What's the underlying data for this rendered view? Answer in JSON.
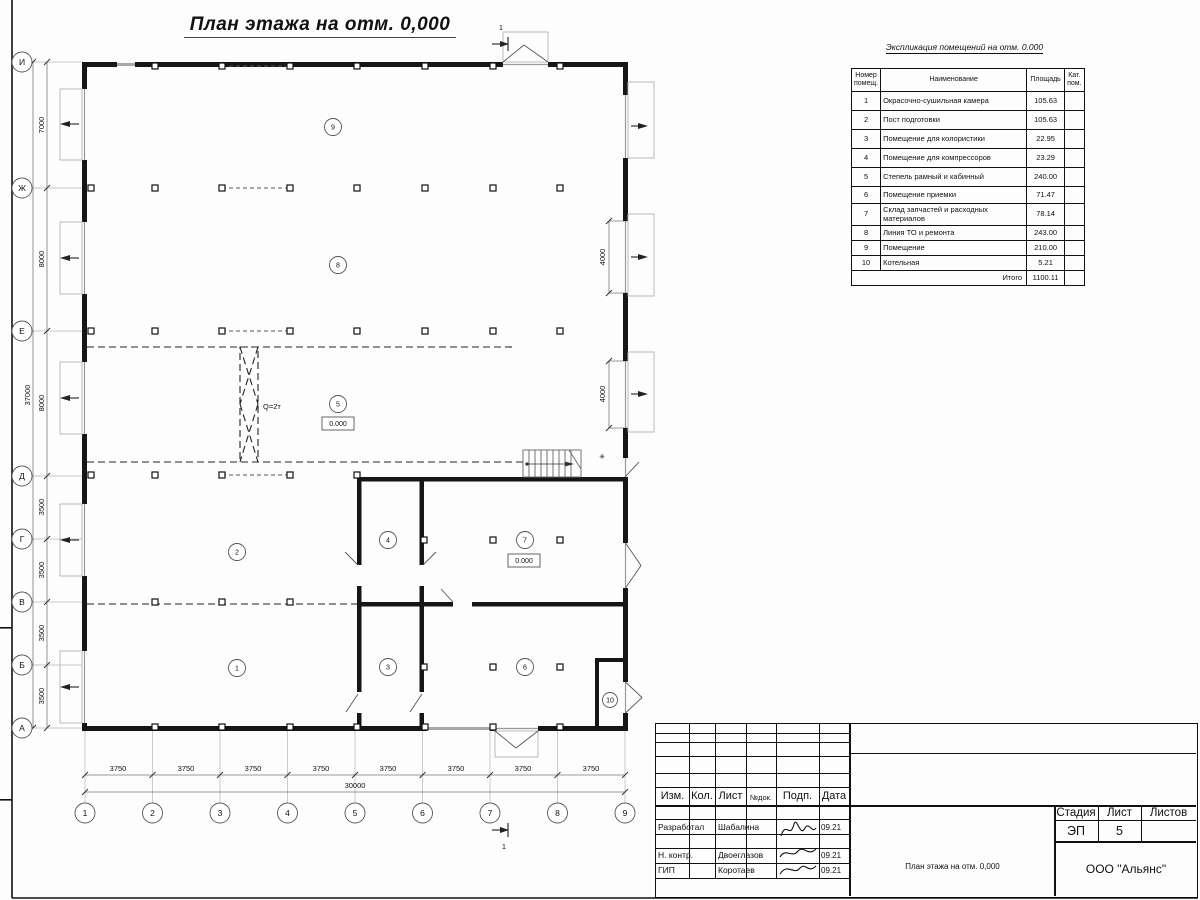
{
  "sheet": {
    "plan_title": "План этажа на отм. 0,000"
  },
  "plan": {
    "axes_left": [
      "И",
      "Ж",
      "Е",
      "Д",
      "Г",
      "В",
      "Б",
      "А"
    ],
    "axes_bottom": [
      "1",
      "2",
      "3",
      "4",
      "5",
      "6",
      "7",
      "8",
      "9"
    ],
    "dims_left": [
      "7000",
      "8000",
      "8000",
      "3500",
      "3500",
      "3500",
      "3500"
    ],
    "dim_left_total": "37000",
    "dims_bottom": [
      "3750",
      "3750",
      "3750",
      "3750",
      "3750",
      "3750",
      "3750",
      "3750"
    ],
    "dim_bottom_total": "30000",
    "dims_right": [
      "4000",
      "4000"
    ],
    "crane_label": "Q=2т",
    "level_marks": [
      "0.000",
      "0.000"
    ],
    "stair_mark": "✳",
    "section_marks": [
      "1",
      "1"
    ],
    "room_numbers": [
      "1",
      "2",
      "3",
      "4",
      "5",
      "6",
      "7",
      "8",
      "9",
      "10"
    ]
  },
  "explication": {
    "title": "Экспликация помещений на отм. 0.000",
    "headers": {
      "num1": "Номер",
      "num2": "помещ.",
      "name": "Наименование",
      "area": "Площадь",
      "cat1": "Кат.",
      "cat2": "пом."
    },
    "rows": [
      {
        "num": "1",
        "name": "Окрасочно-сушильная камера",
        "area": "105.63"
      },
      {
        "num": "2",
        "name": "Пост подготовки",
        "area": "105.63"
      },
      {
        "num": "3",
        "name": "Помещение для колористики",
        "area": "22.95"
      },
      {
        "num": "4",
        "name": "Помещение для компрессоров",
        "area": "23.29"
      },
      {
        "num": "5",
        "name": "Степель рамный и кабинный",
        "area": "240.00"
      },
      {
        "num": "6",
        "name": "Помещение приемки",
        "area": "71.47"
      },
      {
        "num": "7",
        "name": "Склад запчастей и расходных материалов",
        "area": "78.14"
      },
      {
        "num": "8",
        "name": "Линия ТО и ремонта",
        "area": "243.00"
      },
      {
        "num": "9",
        "name": "Помещение",
        "area": "210.00"
      },
      {
        "num": "10",
        "name": "Котельная",
        "area": "5.21"
      }
    ],
    "total_label": "Итого",
    "total_value": "1100.11"
  },
  "title_block": {
    "header_cols": [
      "Изм.",
      "Кол.",
      "Лист",
      "№док.",
      "Подп.",
      "Дата"
    ],
    "rows": [
      {
        "role": "Разработал",
        "name": "Шабалина",
        "date": "09.21"
      },
      {
        "role": "Н. контр.",
        "name": "Двоеглазов",
        "date": "09.21"
      },
      {
        "role": "ГИП",
        "name": "Коротаев",
        "date": "09.21"
      }
    ],
    "doc_title": "План этажа на отм. 0,000",
    "stage_label": "Стадия",
    "sheet_label": "Лист",
    "sheets_label": "Листов",
    "stage_value": "ЭП",
    "sheet_value": "5",
    "company": "ООО \"Альянс\""
  }
}
